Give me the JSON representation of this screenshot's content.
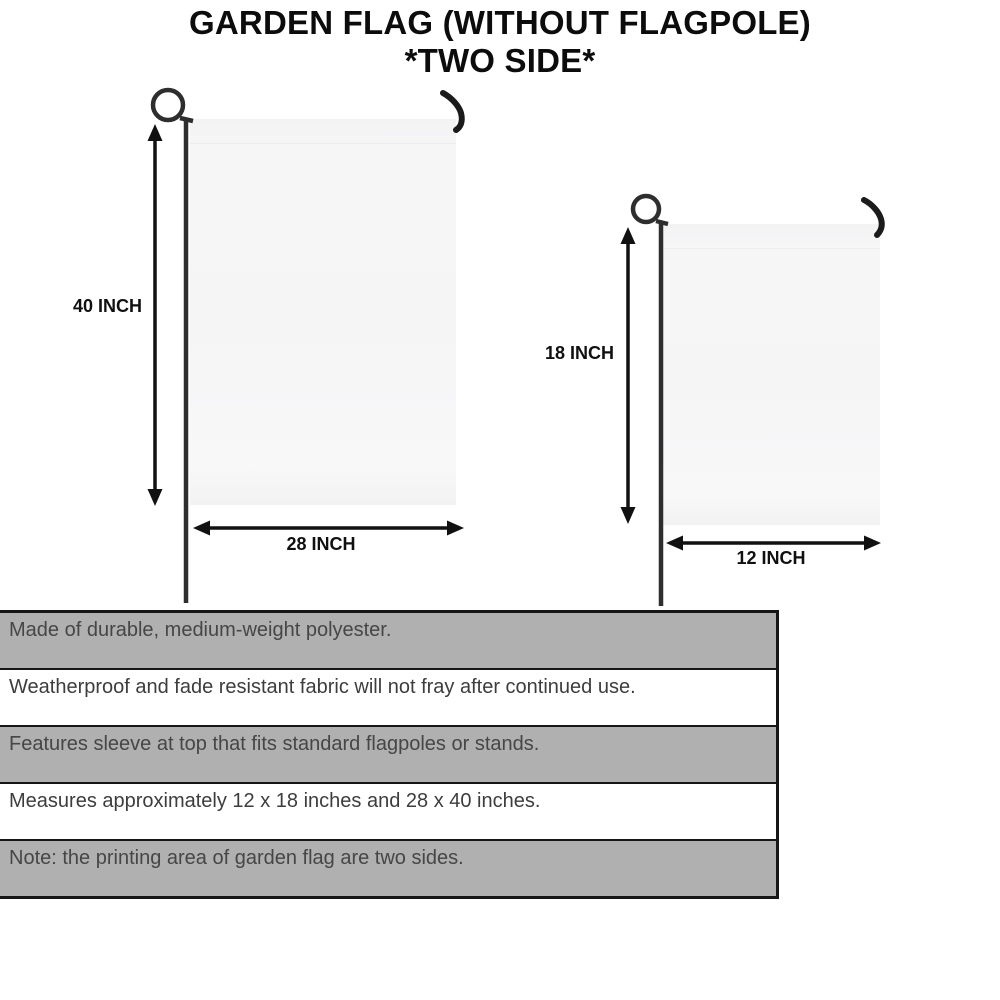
{
  "title": {
    "line1": "GARDEN FLAG (WITHOUT FLAGPOLE)",
    "line2": "*TWO SIDE*"
  },
  "diagram": {
    "large_flag": {
      "height_label": "40 INCH",
      "width_label": "28 INCH"
    },
    "small_flag": {
      "height_label": "18 INCH",
      "width_label": "12 INCH"
    }
  },
  "features": [
    {
      "text": "Made of durable, medium-weight polyester.",
      "shaded": true
    },
    {
      "text": "Weatherproof and fade resistant fabric will not fray after continued use.",
      "shaded": false
    },
    {
      "text": "Features sleeve at top that fits standard flagpoles or stands.",
      "shaded": true
    },
    {
      "text": "Measures approximately 12 x 18 inches and 28 x 40 inches.",
      "shaded": false
    },
    {
      "text": "Note: the printing area of garden flag are two sides.",
      "shaded": true
    }
  ],
  "colors": {
    "row_shaded": "#b0b0b0",
    "row_plain": "#ffffff",
    "pole": "#2e2e2e",
    "arrow": "#111111",
    "flag_fill": "#f5f5f6"
  }
}
